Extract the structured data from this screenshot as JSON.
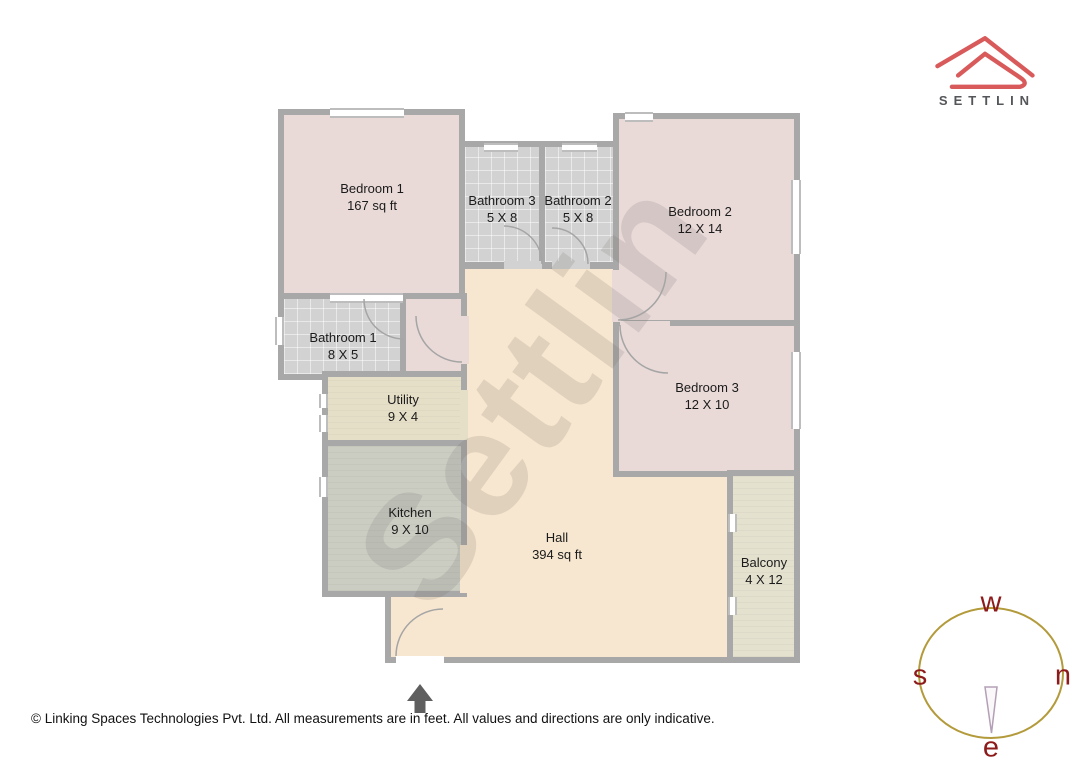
{
  "brand": {
    "name": "SETTLIN",
    "logo_color": "#d95a5a",
    "text_color": "#55565a"
  },
  "floor_plan": {
    "watermark": "Settlin",
    "rooms": [
      {
        "key": "bedroom1",
        "name": "Bedroom 1",
        "dims": "167 sq ft"
      },
      {
        "key": "bathroom3",
        "name": "Bathroom 3",
        "dims": "5 X 8"
      },
      {
        "key": "bathroom2",
        "name": "Bathroom 2",
        "dims": "5 X 8"
      },
      {
        "key": "bedroom2",
        "name": "Bedroom 2",
        "dims": "12 X 14"
      },
      {
        "key": "bedroom3",
        "name": "Bedroom 3",
        "dims": "12 X 10"
      },
      {
        "key": "bathroom1",
        "name": "Bathroom 1",
        "dims": "8 X 5"
      },
      {
        "key": "utility",
        "name": "Utility",
        "dims": "9 X 4"
      },
      {
        "key": "kitchen",
        "name": "Kitchen",
        "dims": "9 X 10"
      },
      {
        "key": "hall",
        "name": "Hall",
        "dims": "394 sq ft"
      },
      {
        "key": "balcony",
        "name": "Balcony",
        "dims": "4 X 12"
      }
    ],
    "colors": {
      "bedroom": "#e9dad8",
      "bathroom": "#d2d2d2",
      "kitchen": "#cbcdc3",
      "utility": "#e6dfc8",
      "hall": "#f8e7d0",
      "balcony": "#e4e1cf",
      "wall": "#a8a8a8"
    }
  },
  "compass": {
    "top": "w",
    "left": "s",
    "right": "n",
    "bottom": "e",
    "circle_color": "#b39b3c",
    "letter_color": "#8e1b1b"
  },
  "footer": {
    "disclaimer": "© Linking Spaces Technologies Pvt. Ltd. All measurements are in feet. All values and directions are only indicative."
  }
}
